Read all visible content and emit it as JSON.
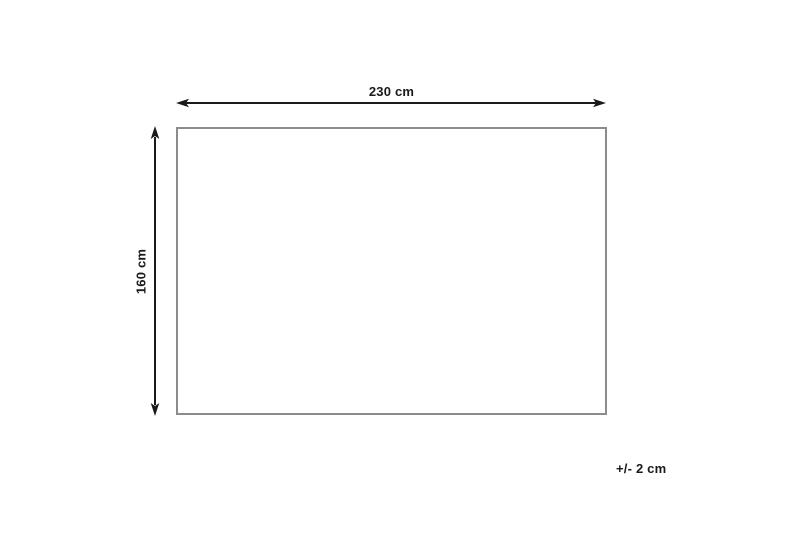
{
  "diagram": {
    "type": "dimension-diagram",
    "subject": "rectangle with measurement arrows",
    "width_label": "230 cm",
    "height_label": "160 cm",
    "tolerance_label": "+/- 2 cm",
    "width_value_cm": 230,
    "height_value_cm": 160,
    "tolerance_cm": 2
  },
  "colors": {
    "arrow": "#1a1a1a",
    "rect_border": "#8c8c8c",
    "background": "#ffffff",
    "text": "#1a1a1a"
  }
}
